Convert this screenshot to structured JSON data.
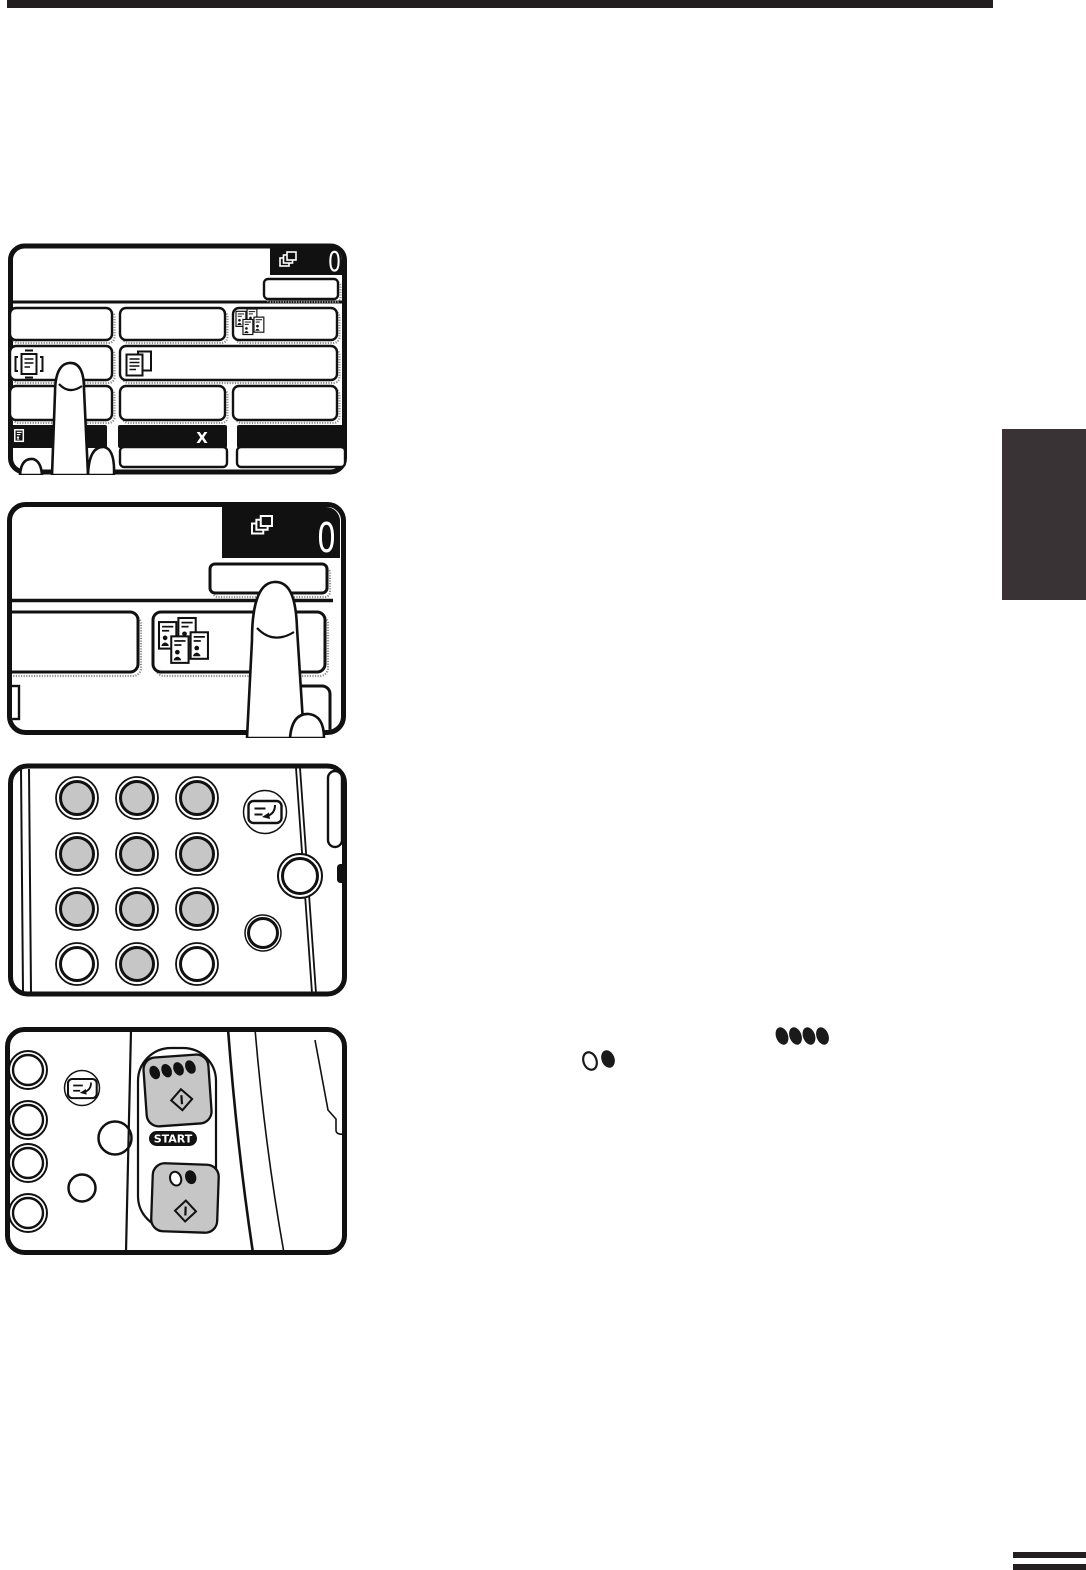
{
  "decor": {
    "top_rule_color": "#231f20",
    "side_tab_color": "#3a3336",
    "footer_bar_color": "#231f20"
  },
  "colors": {
    "key_gray": "#c6c6c6",
    "button_gray": "#c9c9c9",
    "line_black": "#111111",
    "display_black": "#111111",
    "white": "#ffffff"
  },
  "panels": {
    "touchscreen_overview": {
      "copy_count": "0",
      "multiply_label": "X",
      "icons": [
        "copies-icon",
        "dual-page-copy-icon",
        "frame-erase-icon",
        "page-copy-icon",
        "document-icon",
        "finger-illustration"
      ]
    },
    "touchscreen_zoom": {
      "copy_count": "0",
      "icons": [
        "copies-icon",
        "dual-page-copy-icon",
        "finger-illustration"
      ]
    },
    "keypad": {
      "rows": 4,
      "cols": 3,
      "gray_keys": 10,
      "white_keys": 2,
      "icons": [
        "interrupt-icon"
      ]
    },
    "start_keys": {
      "start_label": "START",
      "icons": [
        "interrupt-icon",
        "color-dots-icon",
        "start-diamond-icon",
        "bw-dots-icon"
      ]
    }
  },
  "inline_icons": {
    "color_start_reference": "color-dots-icon",
    "bw_start_reference": "bw-dots-icon"
  }
}
